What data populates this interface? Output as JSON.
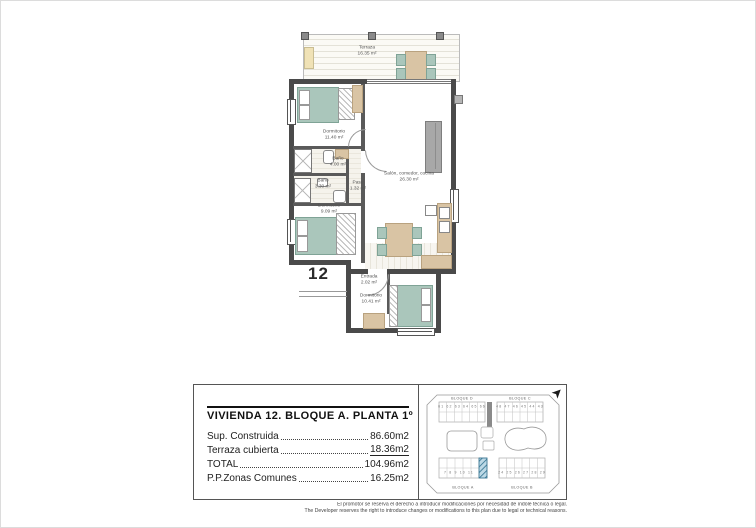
{
  "floor_plan": {
    "unit_number": "12",
    "rooms": {
      "terraza": {
        "name": "Terraza",
        "area": "16.35 m²"
      },
      "dormitorio_1": {
        "name": "Dormitorio",
        "area": "11.40 m²"
      },
      "bano_1": {
        "name": "Baño",
        "area": "4.00 m²"
      },
      "bano_2": {
        "name": "Baño",
        "area": "3.30 m²"
      },
      "paso": {
        "name": "Paso",
        "area": "1.32 m²"
      },
      "dormitorio_2": {
        "name": "Dormitorio",
        "area": "9.09 m²"
      },
      "salon": {
        "name": "Salón, comedor, cocina",
        "area": "26.30 m²"
      },
      "entrada": {
        "name": "Entrada",
        "area": "2.02 m²"
      },
      "dormitorio_3": {
        "name": "Dormitorio",
        "area": "10.41 m²"
      }
    }
  },
  "info_panel": {
    "title": "VIVIENDA 12. BLOQUE A. PLANTA 1º",
    "rows": [
      {
        "label": "Sup. Construida",
        "value": "86.60m2"
      },
      {
        "label": "Terraza cubierta",
        "value": "18.36m2"
      },
      {
        "label": "TOTAL",
        "value": "104.96m2"
      },
      {
        "label": "P.P.Zonas Comunes",
        "value": "16.25m2"
      }
    ]
  },
  "site_plan": {
    "north_arrow_icon": "➤",
    "block_d": {
      "name": "BLOQUE D",
      "units": "61 62 63 64 65 66"
    },
    "block_c": {
      "name": "BLOQUE C",
      "units": "48 47 46 45 44 43"
    },
    "block_a": {
      "name": "BLOQUE A",
      "units": "7 8 9 10 11"
    },
    "block_b": {
      "name": "BLOQUE B",
      "units": "24 25 26 27 28 29"
    },
    "highlighted_unit": "12"
  },
  "footer": {
    "line_es": "El promotor se reserva el derecho a introducir modificaciones por necesidad de índole técnica o legal.",
    "line_en": "The Developer reserves the right to introduce changes or modifications to this plan due to legal or technical reasons."
  },
  "colors": {
    "wall": "#4a4a4a",
    "furniture_teal": "#aac6bb",
    "furniture_tan": "#d9c4a4",
    "highlight_hatch": "#2e6f8e"
  }
}
